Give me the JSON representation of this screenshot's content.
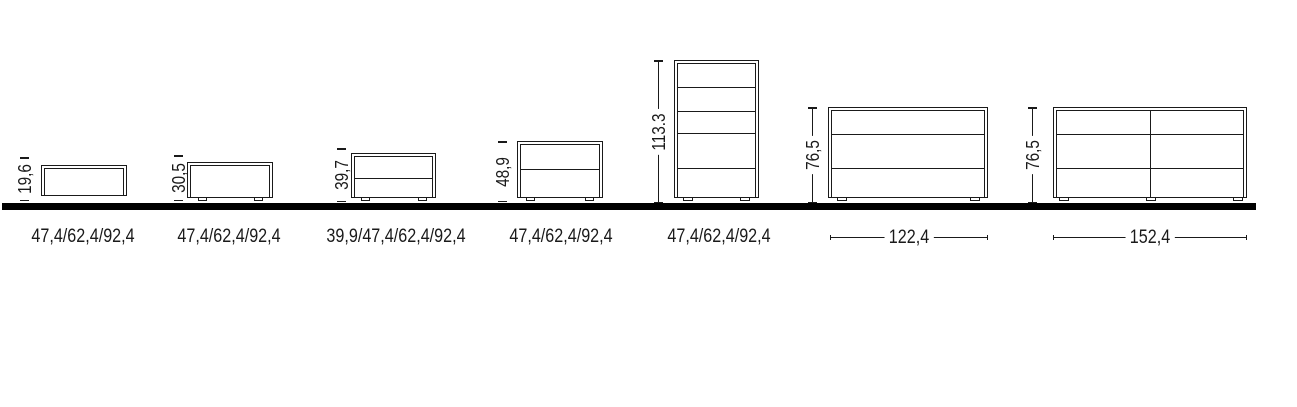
{
  "diagram": {
    "description": "Furniture dimension line drawing: seven bedroom storage units standing on a ground line, each with a vertical height measurement and a horizontal width measurement",
    "line_color": "#1a1a1a",
    "ground_line_color": "#000000",
    "background_color": "#ffffff"
  },
  "items": [
    {
      "kind": "wall-hung bedside unit, open box",
      "height_label": "19,6",
      "width_label": "47,4/62,4/92,4"
    },
    {
      "kind": "bedside unit on feet, single front",
      "height_label": "30,5",
      "width_label": "47,4/62,4/92,4"
    },
    {
      "kind": "bedside unit on feet, 2 drawers",
      "height_label": "39,7",
      "width_label": "39,9/47,4/62,4/92,4"
    },
    {
      "kind": "bedside unit on feet, 2 drawers tall",
      "height_label": "48,9",
      "width_label": "47,4/62,4/92,4"
    },
    {
      "kind": "tallboy chest, 5 drawers",
      "height_label": "113.3",
      "width_label": "47,4/62,4/92,4"
    },
    {
      "kind": "dresser, 3 drawers",
      "height_label": "76,5",
      "width_label": "122,4"
    },
    {
      "kind": "double dresser, 6 drawers",
      "height_label": "76,5",
      "width_label": "152,4"
    }
  ]
}
